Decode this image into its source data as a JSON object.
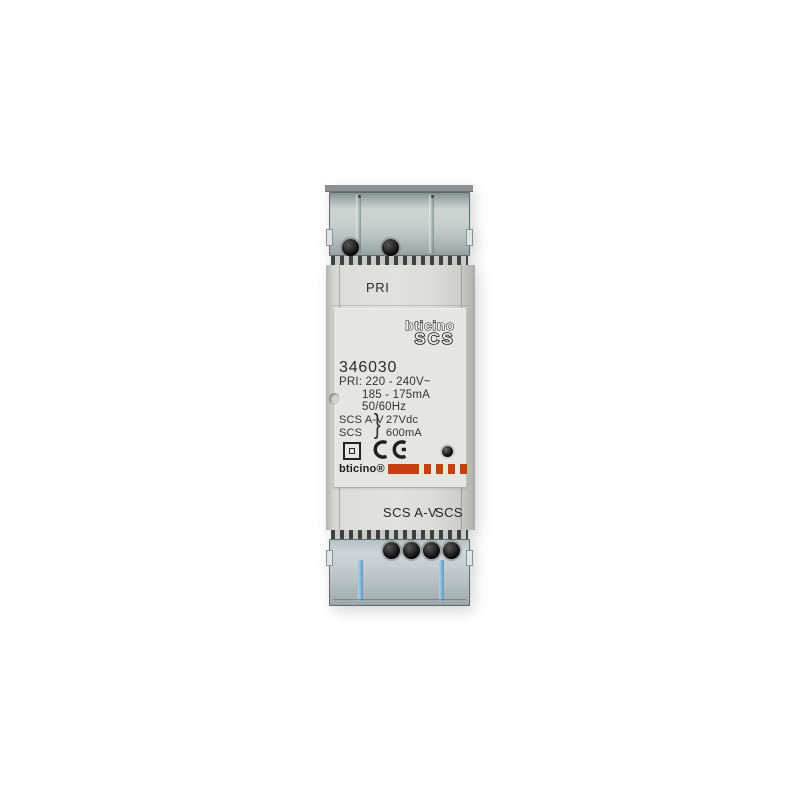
{
  "device": {
    "top_terminal_label": "PRI",
    "panel": {
      "brand_logo": "bticino",
      "bus_logo": "SCS",
      "model": "346030",
      "specs": [
        "PRI: 220 - 240V~",
        "185 - 175mA",
        "50/60Hz"
      ],
      "outputs": [
        {
          "name": "SCS A-V",
          "value": "27Vdc"
        },
        {
          "name": "SCS",
          "value": "600mA"
        }
      ],
      "output_brace": "}",
      "certification_mark": "CE",
      "footer_brand": "bticino®"
    },
    "bottom_terminal_labels": {
      "left": "SCS A-V",
      "right": "SCS"
    },
    "colors": {
      "body": "#dcddd9",
      "label_panel": "#e5e5e1",
      "din_bar": "#8d8f90",
      "terminal_cover_glass": "#c0c9c8",
      "brand_red": "#c63f10",
      "text": "#2b2b2b",
      "wire_clip_blue": "#7fb6dc"
    }
  }
}
